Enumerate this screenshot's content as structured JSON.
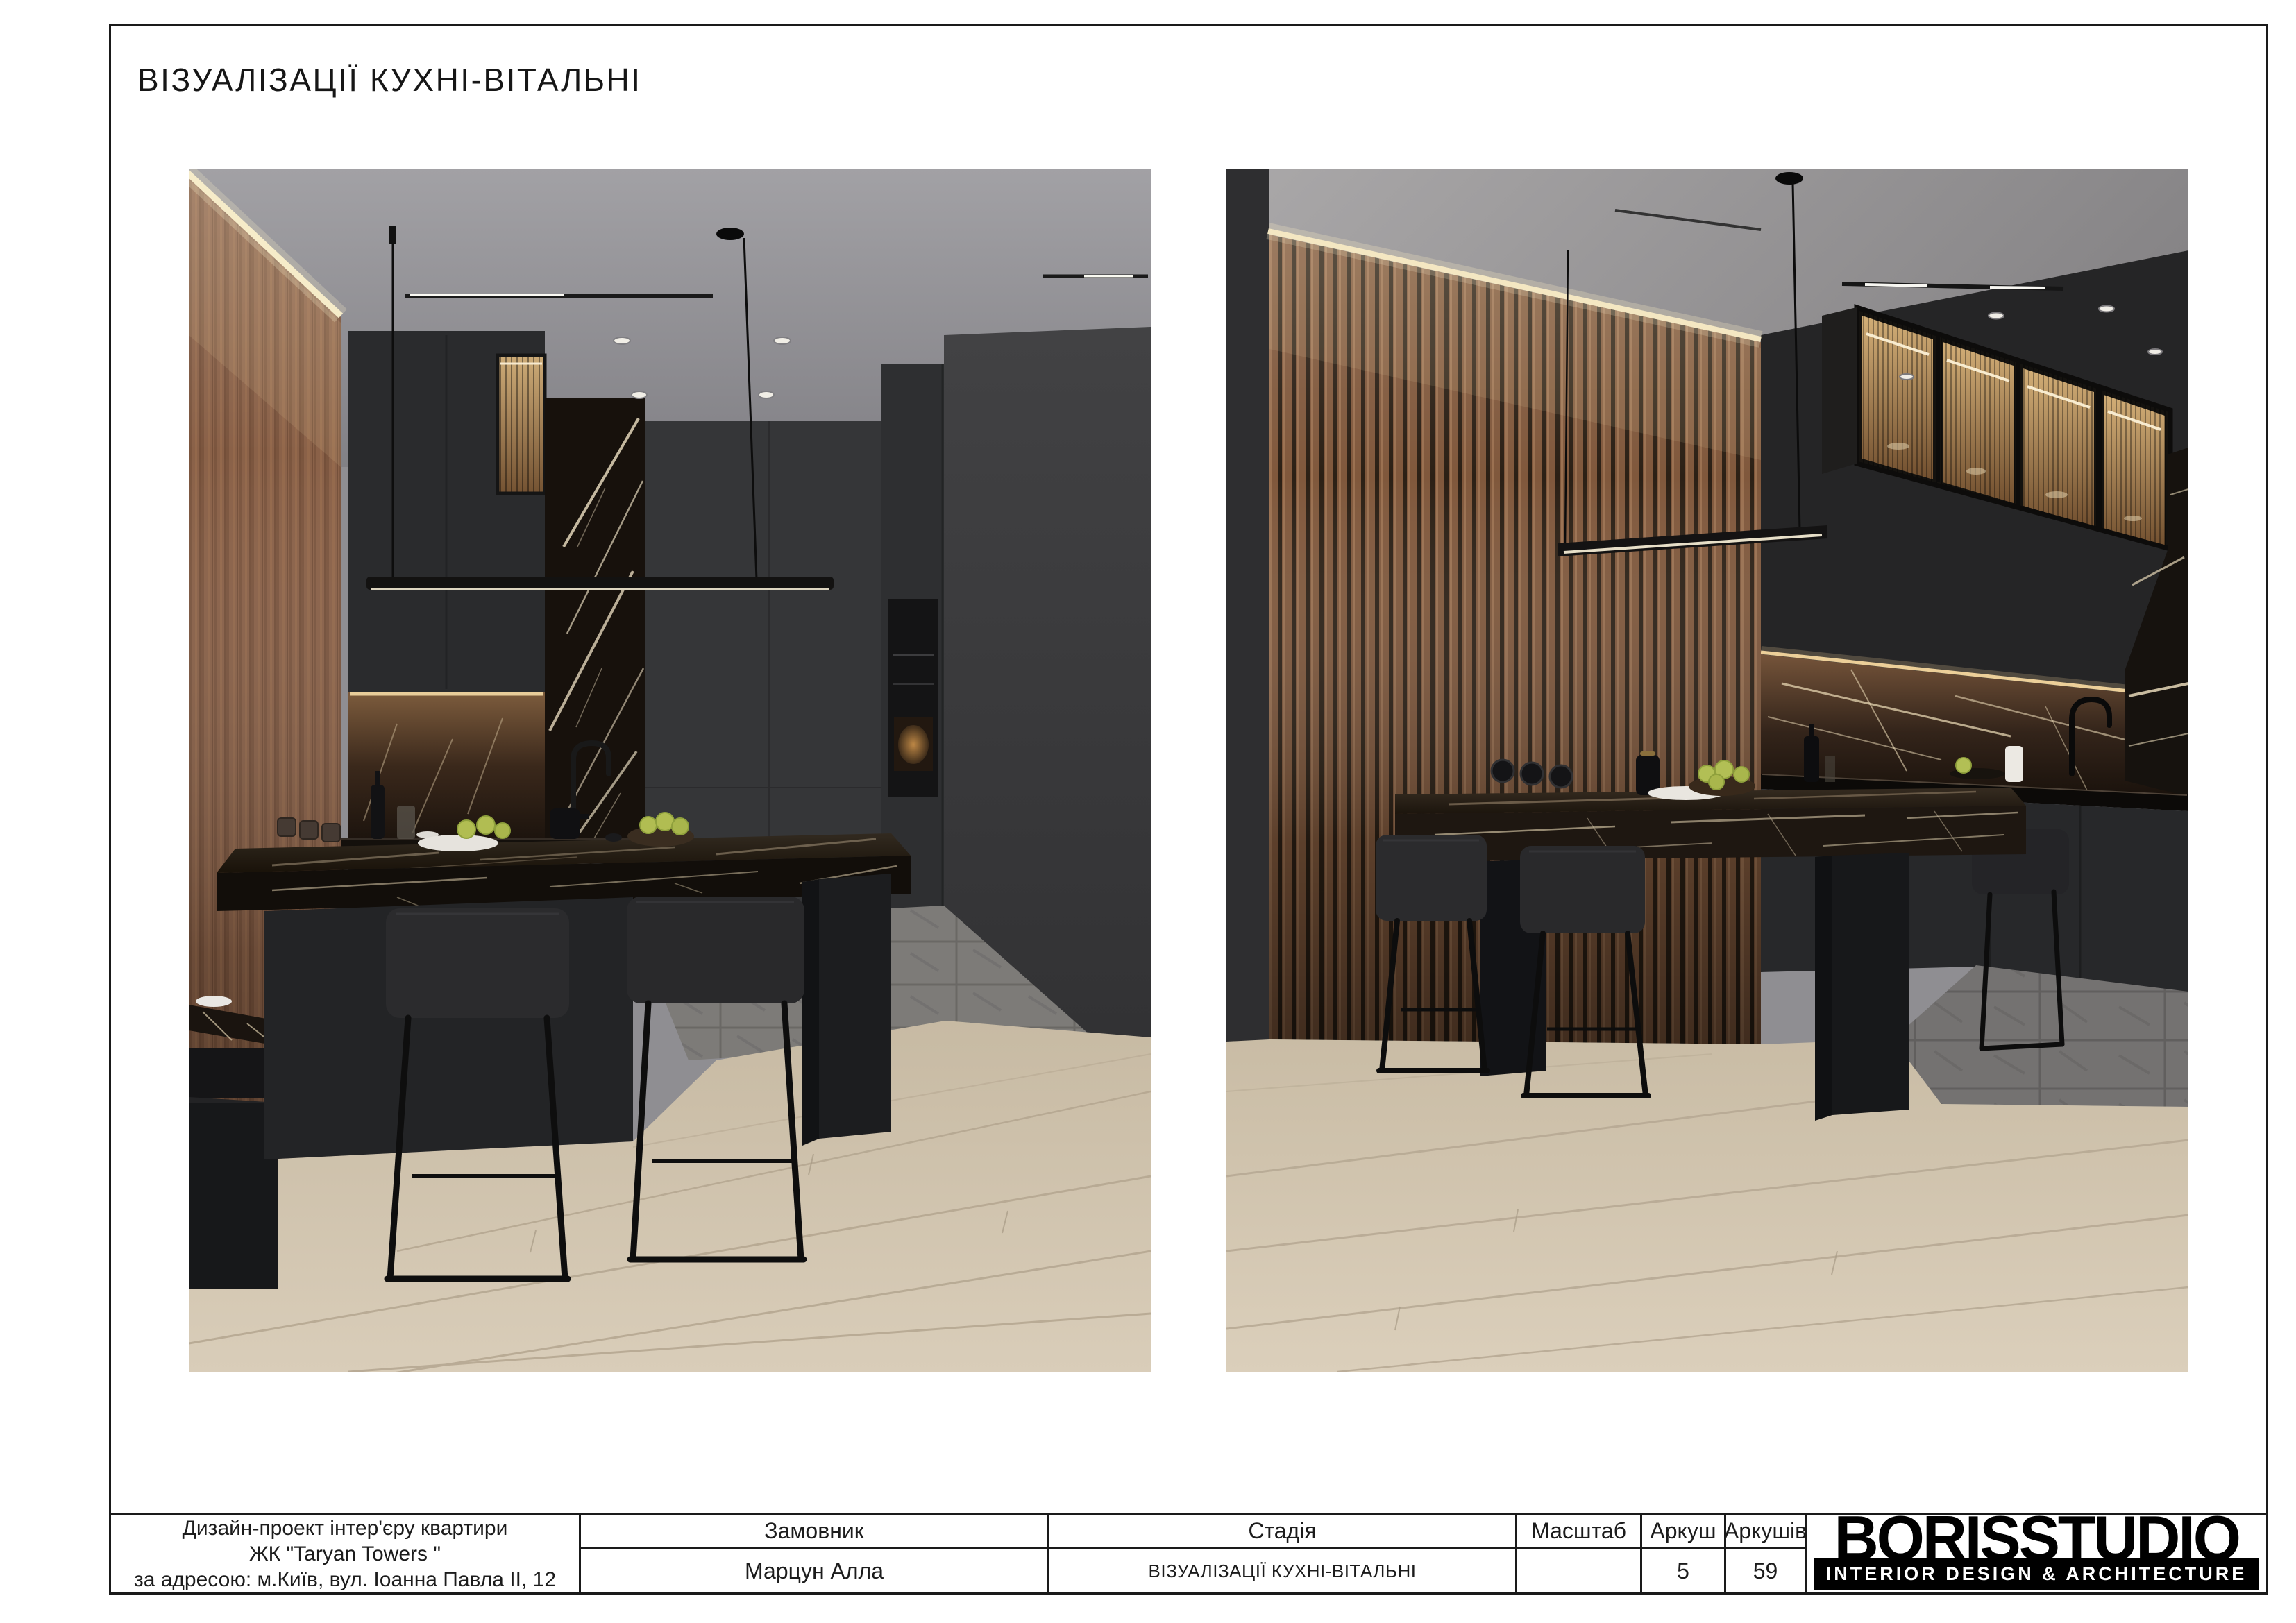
{
  "page": {
    "title": "ВІЗУАЛІЗАЦІЇ КУХНІ-ВІТАЛЬНІ"
  },
  "title_block": {
    "project": {
      "line1": "Дизайн-проект інтер'єру квартири",
      "line2": "ЖК \"Taryan Towers \"",
      "line3": "за адресою: м.Київ, вул. Іоанна Павла II, 12"
    },
    "customer": {
      "label": "Замовник",
      "value": "Марцун Алла"
    },
    "stage": {
      "label": "Стадія",
      "value": "ВІЗУАЛІЗАЦІЇ КУХНІ-ВІТАЛЬНІ"
    },
    "scale": {
      "label": "Масштаб",
      "value": ""
    },
    "sheet": {
      "label": "Аркуш",
      "value": "5"
    },
    "sheets": {
      "label": "Аркушів",
      "value": "59"
    },
    "logo": {
      "name": "BORISSTUDIO",
      "tagline": "INTERIOR DESIGN & ARCHITECTURE"
    }
  },
  "colors": {
    "paper": "#ffffff",
    "ink": "#1c1c1c",
    "frame": "#1a1a1a",
    "logo_bg": "#000000",
    "logo_fg": "#ffffff",
    "render_ceiling": "#8f8e92",
    "render_dark_wall": "#3b3b3d",
    "render_cabinet": "#242526",
    "render_wood": "#8a6148",
    "render_marble": "#17120e",
    "render_marble_vein": "#ddd0b4",
    "render_led": "#f6ecc9",
    "render_floor": "#d1c5b0",
    "render_apple": "#aeb84f"
  }
}
